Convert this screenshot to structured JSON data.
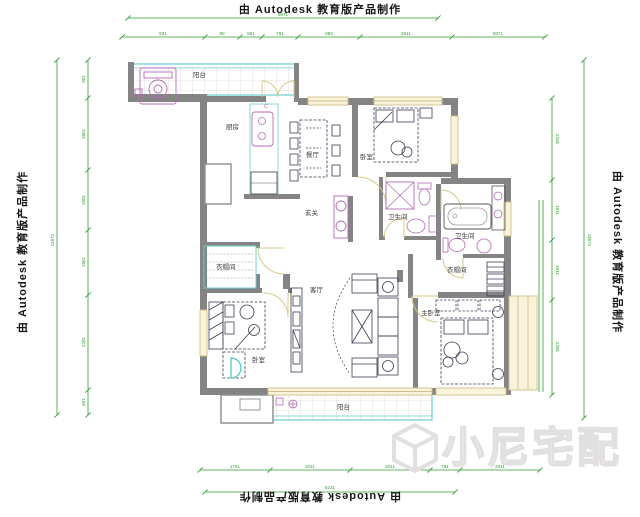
{
  "branding": {
    "autodesk_credit": "由 Autodesk 教育版产品制作",
    "watermark_text": "小尼宅配"
  },
  "rooms": [
    {
      "id": "balcony-top",
      "label": "阳台"
    },
    {
      "id": "kitchen",
      "label": "厨房"
    },
    {
      "id": "dining-room",
      "label": "餐厅"
    },
    {
      "id": "bedroom-top-right",
      "label": "卧室"
    },
    {
      "id": "bathroom-center",
      "label": "卫生间"
    },
    {
      "id": "bathroom-right",
      "label": "卫生间"
    },
    {
      "id": "cloakroom-right",
      "label": "衣帽间"
    },
    {
      "id": "master-bedroom",
      "label": "主卧室"
    },
    {
      "id": "living-room",
      "label": "客厅"
    },
    {
      "id": "bedroom-left",
      "label": "卧室"
    },
    {
      "id": "cloakroom-left",
      "label": "衣帽间"
    },
    {
      "id": "entry-hall",
      "label": "玄关"
    },
    {
      "id": "balcony-bottom",
      "label": "阳台"
    }
  ],
  "annotations": {
    "column_mark": "C"
  },
  "dimensions": {
    "top_overall": "9871",
    "top_chain": [
      "931",
      "90",
      "881",
      "761",
      "883",
      "2611",
      "5871"
    ],
    "left_overall": "11871",
    "left_chain": [
      "901",
      "1801",
      "1501",
      "1561",
      "2281",
      "601"
    ],
    "right_overall": "11871",
    "right_chain": [
      "2101",
      "1511",
      "1511",
      "2281"
    ],
    "bottom_overall": "6231",
    "bottom_chain": [
      "1761",
      "2011",
      "2011",
      "761",
      "2011"
    ]
  },
  "colors": {
    "dimension_green": "#2f9e2f",
    "wall_gray": "#848484",
    "accent_cyan": "#6ccdd1",
    "accent_magenta": "#b46ab4",
    "window_cream": "#faf3dc",
    "furniture_ink": "#3d3d55",
    "watermark_gray": "#e2dfdf"
  }
}
